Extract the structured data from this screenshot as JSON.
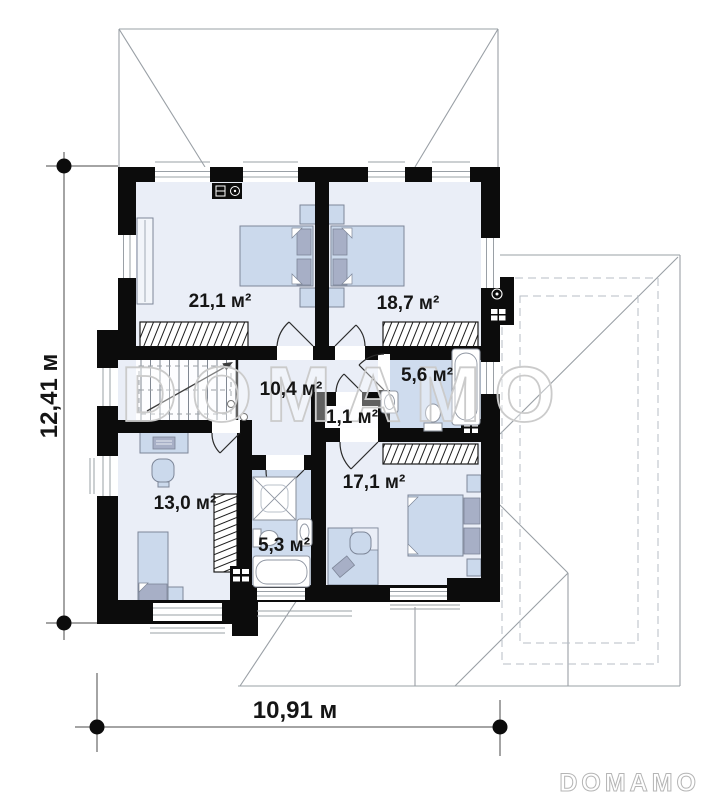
{
  "colors": {
    "wall": "#0c0c0c",
    "floor-light": "#eaeef7",
    "floor-bath": "#cfdcee",
    "floor-white": "#fdfdff",
    "furniture": "#cbd9ec",
    "furniture-dark": "#a7afc6",
    "furniture-line": "#7d8698",
    "fixture-line": "#8f96a2",
    "glazing": "#9aa0a6",
    "roof-line": "#9aa0a6",
    "dash-line": "#b7bec6",
    "hatch-ink": "#1c1c1c",
    "ink": "#151515",
    "watermark": "#cbcbcb",
    "logo": "#b5b5b5"
  },
  "rooms": [
    {
      "name": "bedroom-top-left",
      "area_label": "21,1 м²"
    },
    {
      "name": "bedroom-top-right",
      "area_label": "18,7 м²"
    },
    {
      "name": "hall",
      "area_label": "10,4 м²"
    },
    {
      "name": "bathroom-top",
      "area_label": "5,6 м²"
    },
    {
      "name": "closet",
      "area_label": "1,1 м²"
    },
    {
      "name": "bedroom-bottom-left",
      "area_label": "13,0 м²"
    },
    {
      "name": "bathroom-bottom",
      "area_label": "5,3 м²"
    },
    {
      "name": "bedroom-bottom-right",
      "area_label": "17,1 м²"
    }
  ],
  "dimensions": {
    "height_label": "12,41 м",
    "width_label": "10,91 м"
  },
  "watermark": {
    "text": "DOMAMO"
  },
  "brand": {
    "logo_text": "DOMAMO"
  }
}
